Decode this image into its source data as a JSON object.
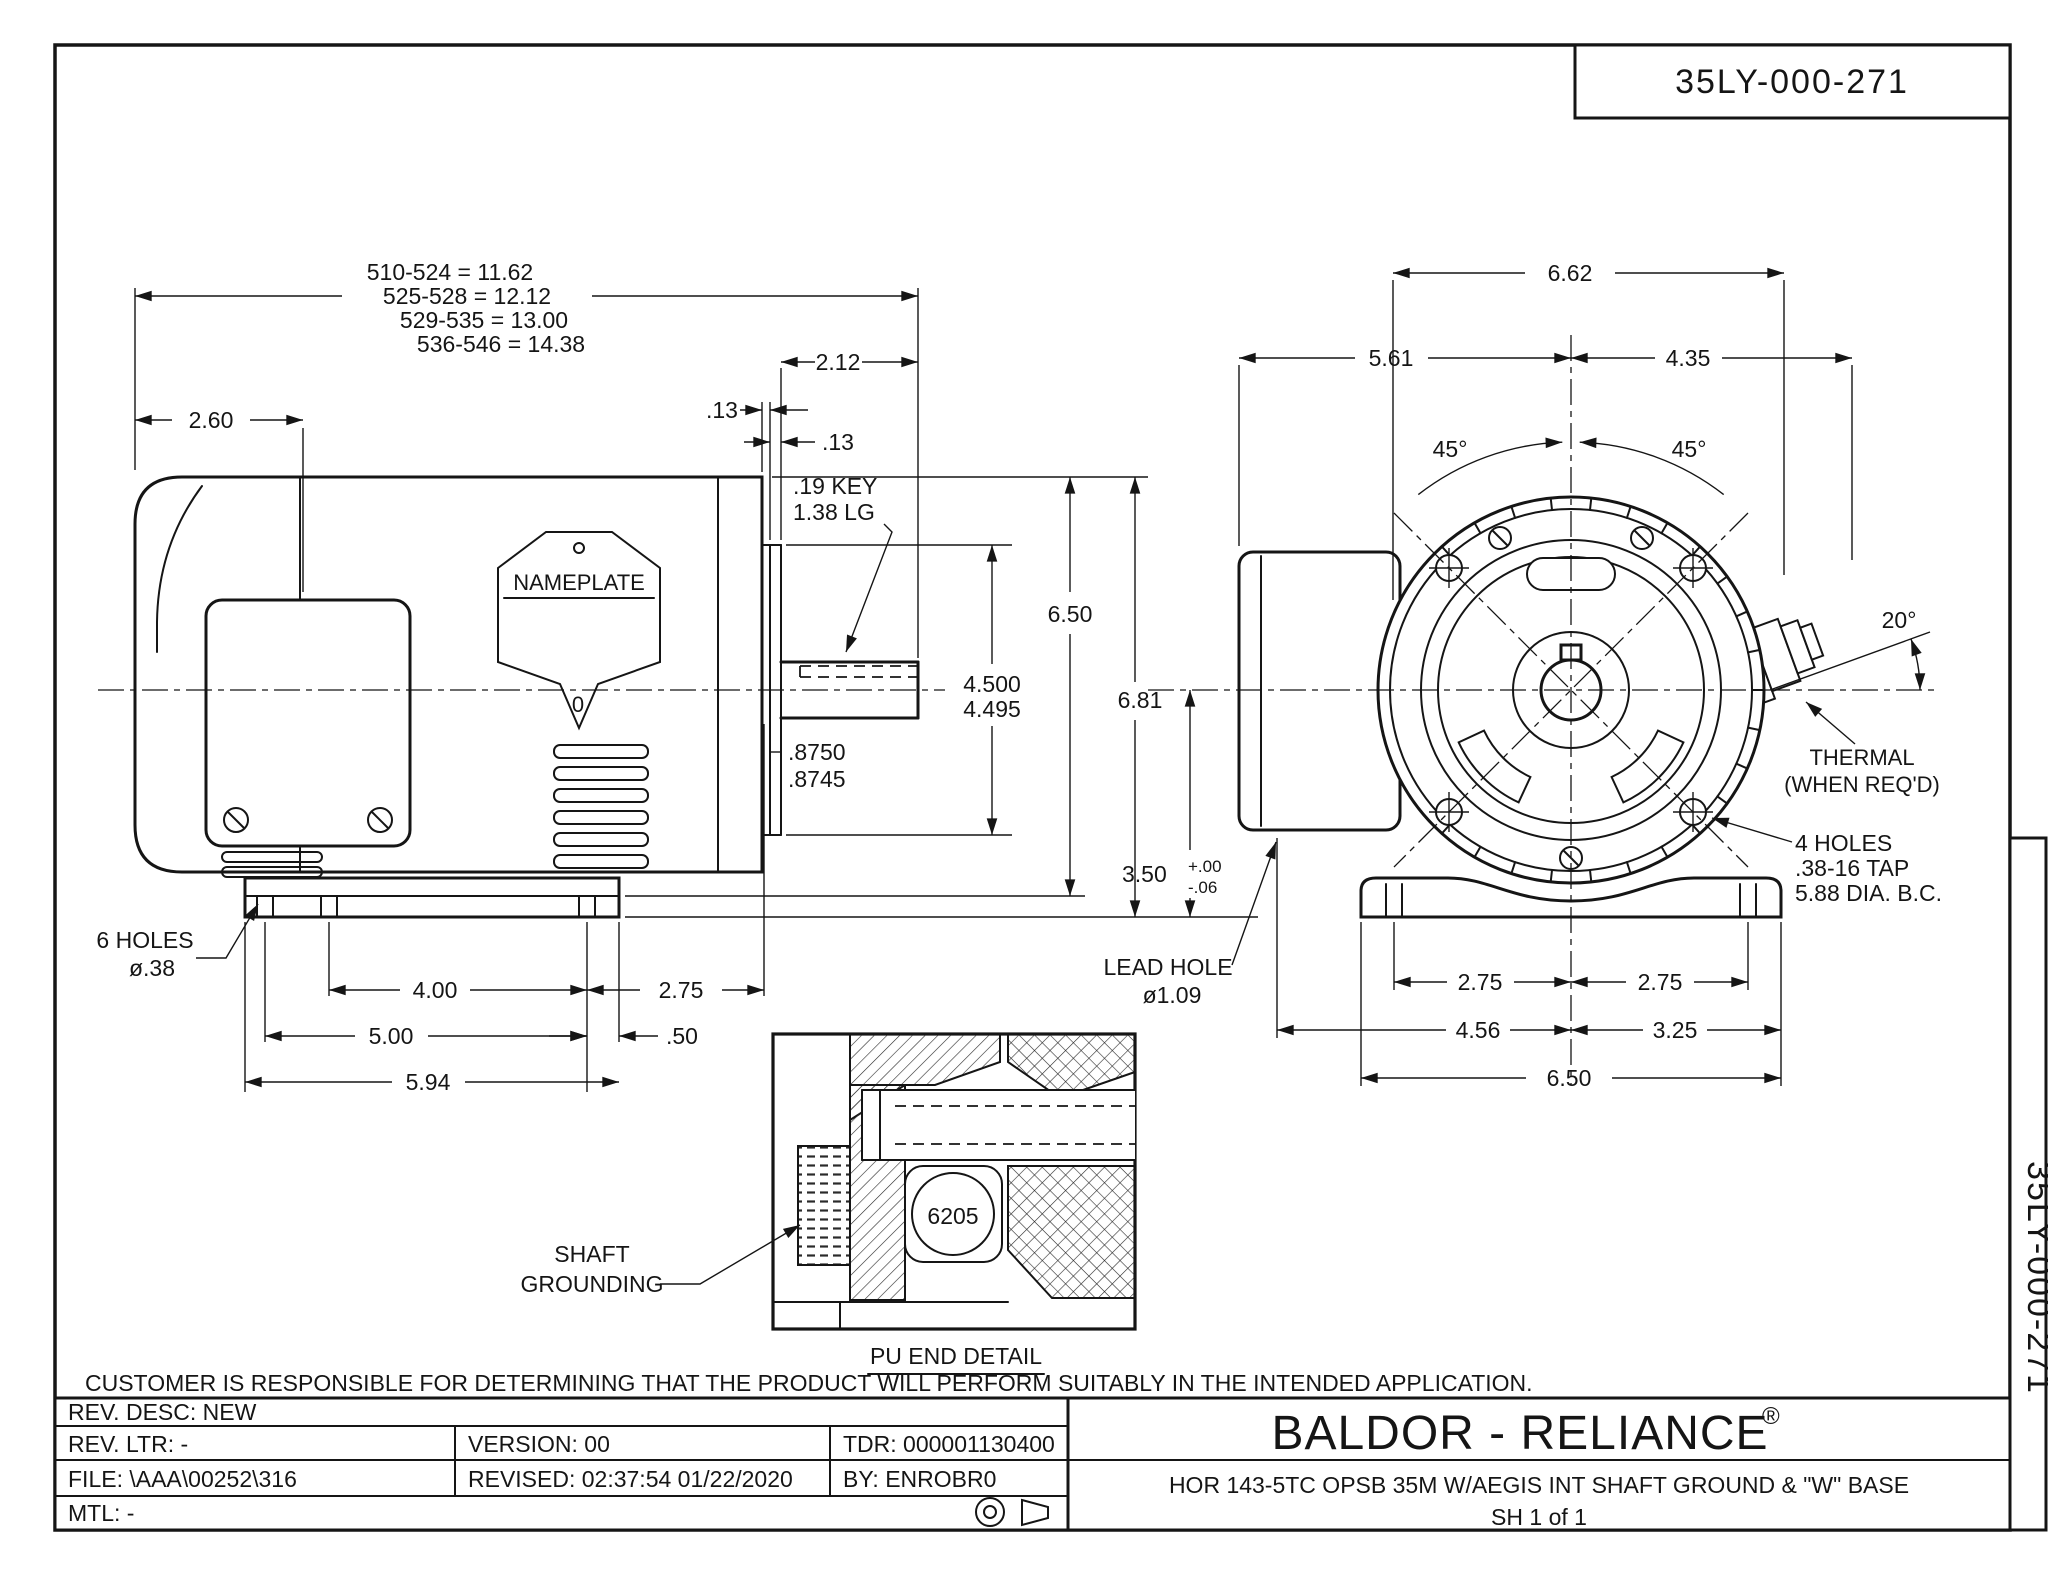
{
  "page": {
    "drawing_number": "35LY-000-271",
    "disclaimer": "CUSTOMER IS RESPONSIBLE FOR DETERMINING THAT THE PRODUCT WILL PERFORM SUITABLY IN THE INTENDED APPLICATION."
  },
  "side_view": {
    "stack_dims": [
      "510-524 = 11.62",
      "525-528 = 12.12",
      "529-535 = 13.00",
      "536-546 = 14.38"
    ],
    "dim_rear_to_box": "2.60",
    "dim_shaft_len": "2.12",
    "dim_step_a": ".13",
    "dim_step_b": ".13",
    "key_note_line1": ".19 KEY",
    "key_note_line2": "1.38 LG",
    "nameplate_label": "NAMEPLATE",
    "nameplate_zero": "0",
    "dim_height": "6.50",
    "dim_rabbet_max": "4.500",
    "dim_rabbet_min": "4.495",
    "dim_shaft_dia_max": ".8750",
    "dim_shaft_dia_min": ".8745",
    "holes_note_line1": "6 HOLES",
    "holes_note_line2": "ø.38",
    "dim_bolt_span": "4.00",
    "dim_bolt_to_face": "2.75",
    "dim_slot_span": "5.00",
    "dim_front_edge": ".50",
    "dim_base_len": "5.94"
  },
  "end_view": {
    "dim_width_overall": "6.62",
    "dim_left_of_center": "5.61",
    "dim_right_of_center": "4.35",
    "angle_left": "45°",
    "angle_right": "45°",
    "angle_thermal": "20°",
    "thermal_line1": "THERMAL",
    "thermal_line2": "(WHEN REQ'D)",
    "tap_note_line1": "4 HOLES",
    "tap_note_line2": ".38-16 TAP",
    "tap_note_line3": "5.88 DIA. B.C.",
    "lead_hole_line1": "LEAD HOLE",
    "lead_hole_line2": "ø1.09",
    "dim_height_overall": "6.81",
    "dim_shaft_height": "3.50",
    "tol_plus": "+.00",
    "tol_minus": "-.06",
    "dim_bolt_left": "2.75",
    "dim_bolt_right": "2.75",
    "dim_box_to_center": "4.56",
    "dim_center_to_edge": "3.25",
    "dim_base_width": "6.50"
  },
  "detail": {
    "label_line1": "SHAFT",
    "label_line2": "GROUNDING",
    "bearing_number": "6205",
    "caption": "PU END DETAIL"
  },
  "title_block": {
    "rev_desc": "REV. DESC:  NEW",
    "rev_ltr": "REV. LTR:  -",
    "version": "VERSION: 00",
    "tdr": "TDR: 000001130400",
    "file": "FILE: \\AAA\\00252\\316",
    "revised": "REVISED: 02:37:54 01/22/2020",
    "by": "BY: ENROBR0",
    "mtl": "MTL: -",
    "brand": "BALDOR - RELIANCE",
    "brand_reg": "®",
    "description": "HOR 143-5TC OPSB 35M W/AEGIS INT SHAFT GROUND & \"W\" BASE",
    "sheet": "SH 1 of 1"
  }
}
